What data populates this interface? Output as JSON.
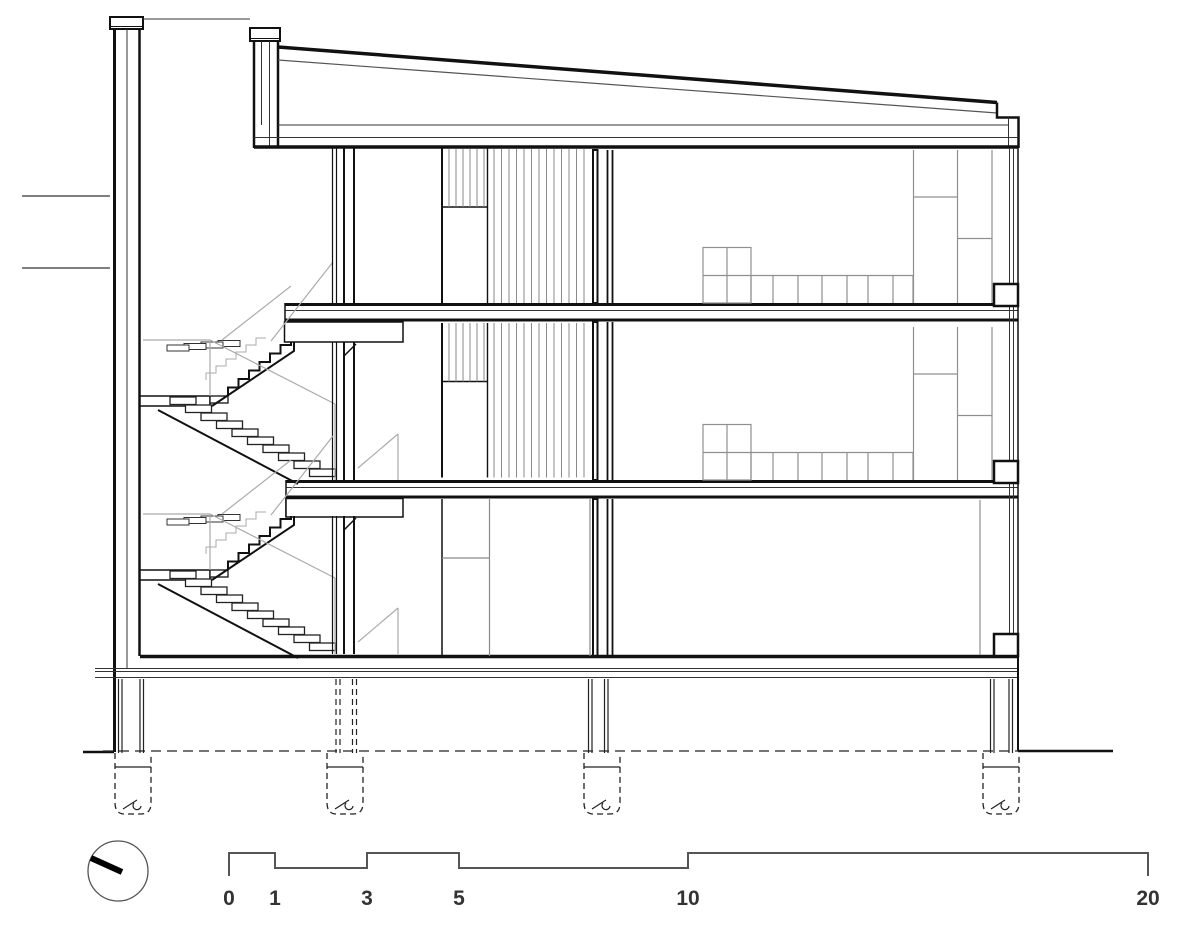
{
  "scale_bar": {
    "unit": "m",
    "labels": [
      "0",
      "1",
      "3",
      "5",
      "10",
      "20"
    ]
  },
  "north_indicator": {
    "icon": "compass-circle-icon"
  },
  "colors": {
    "line": "#1a1a1a",
    "secondary_line": "#555555",
    "slat_gray": "#8a8a8a",
    "furniture_gray": "#8f8f8f",
    "railing_gray": "#ababab",
    "label_text": "#333333",
    "background": "#ffffff"
  }
}
